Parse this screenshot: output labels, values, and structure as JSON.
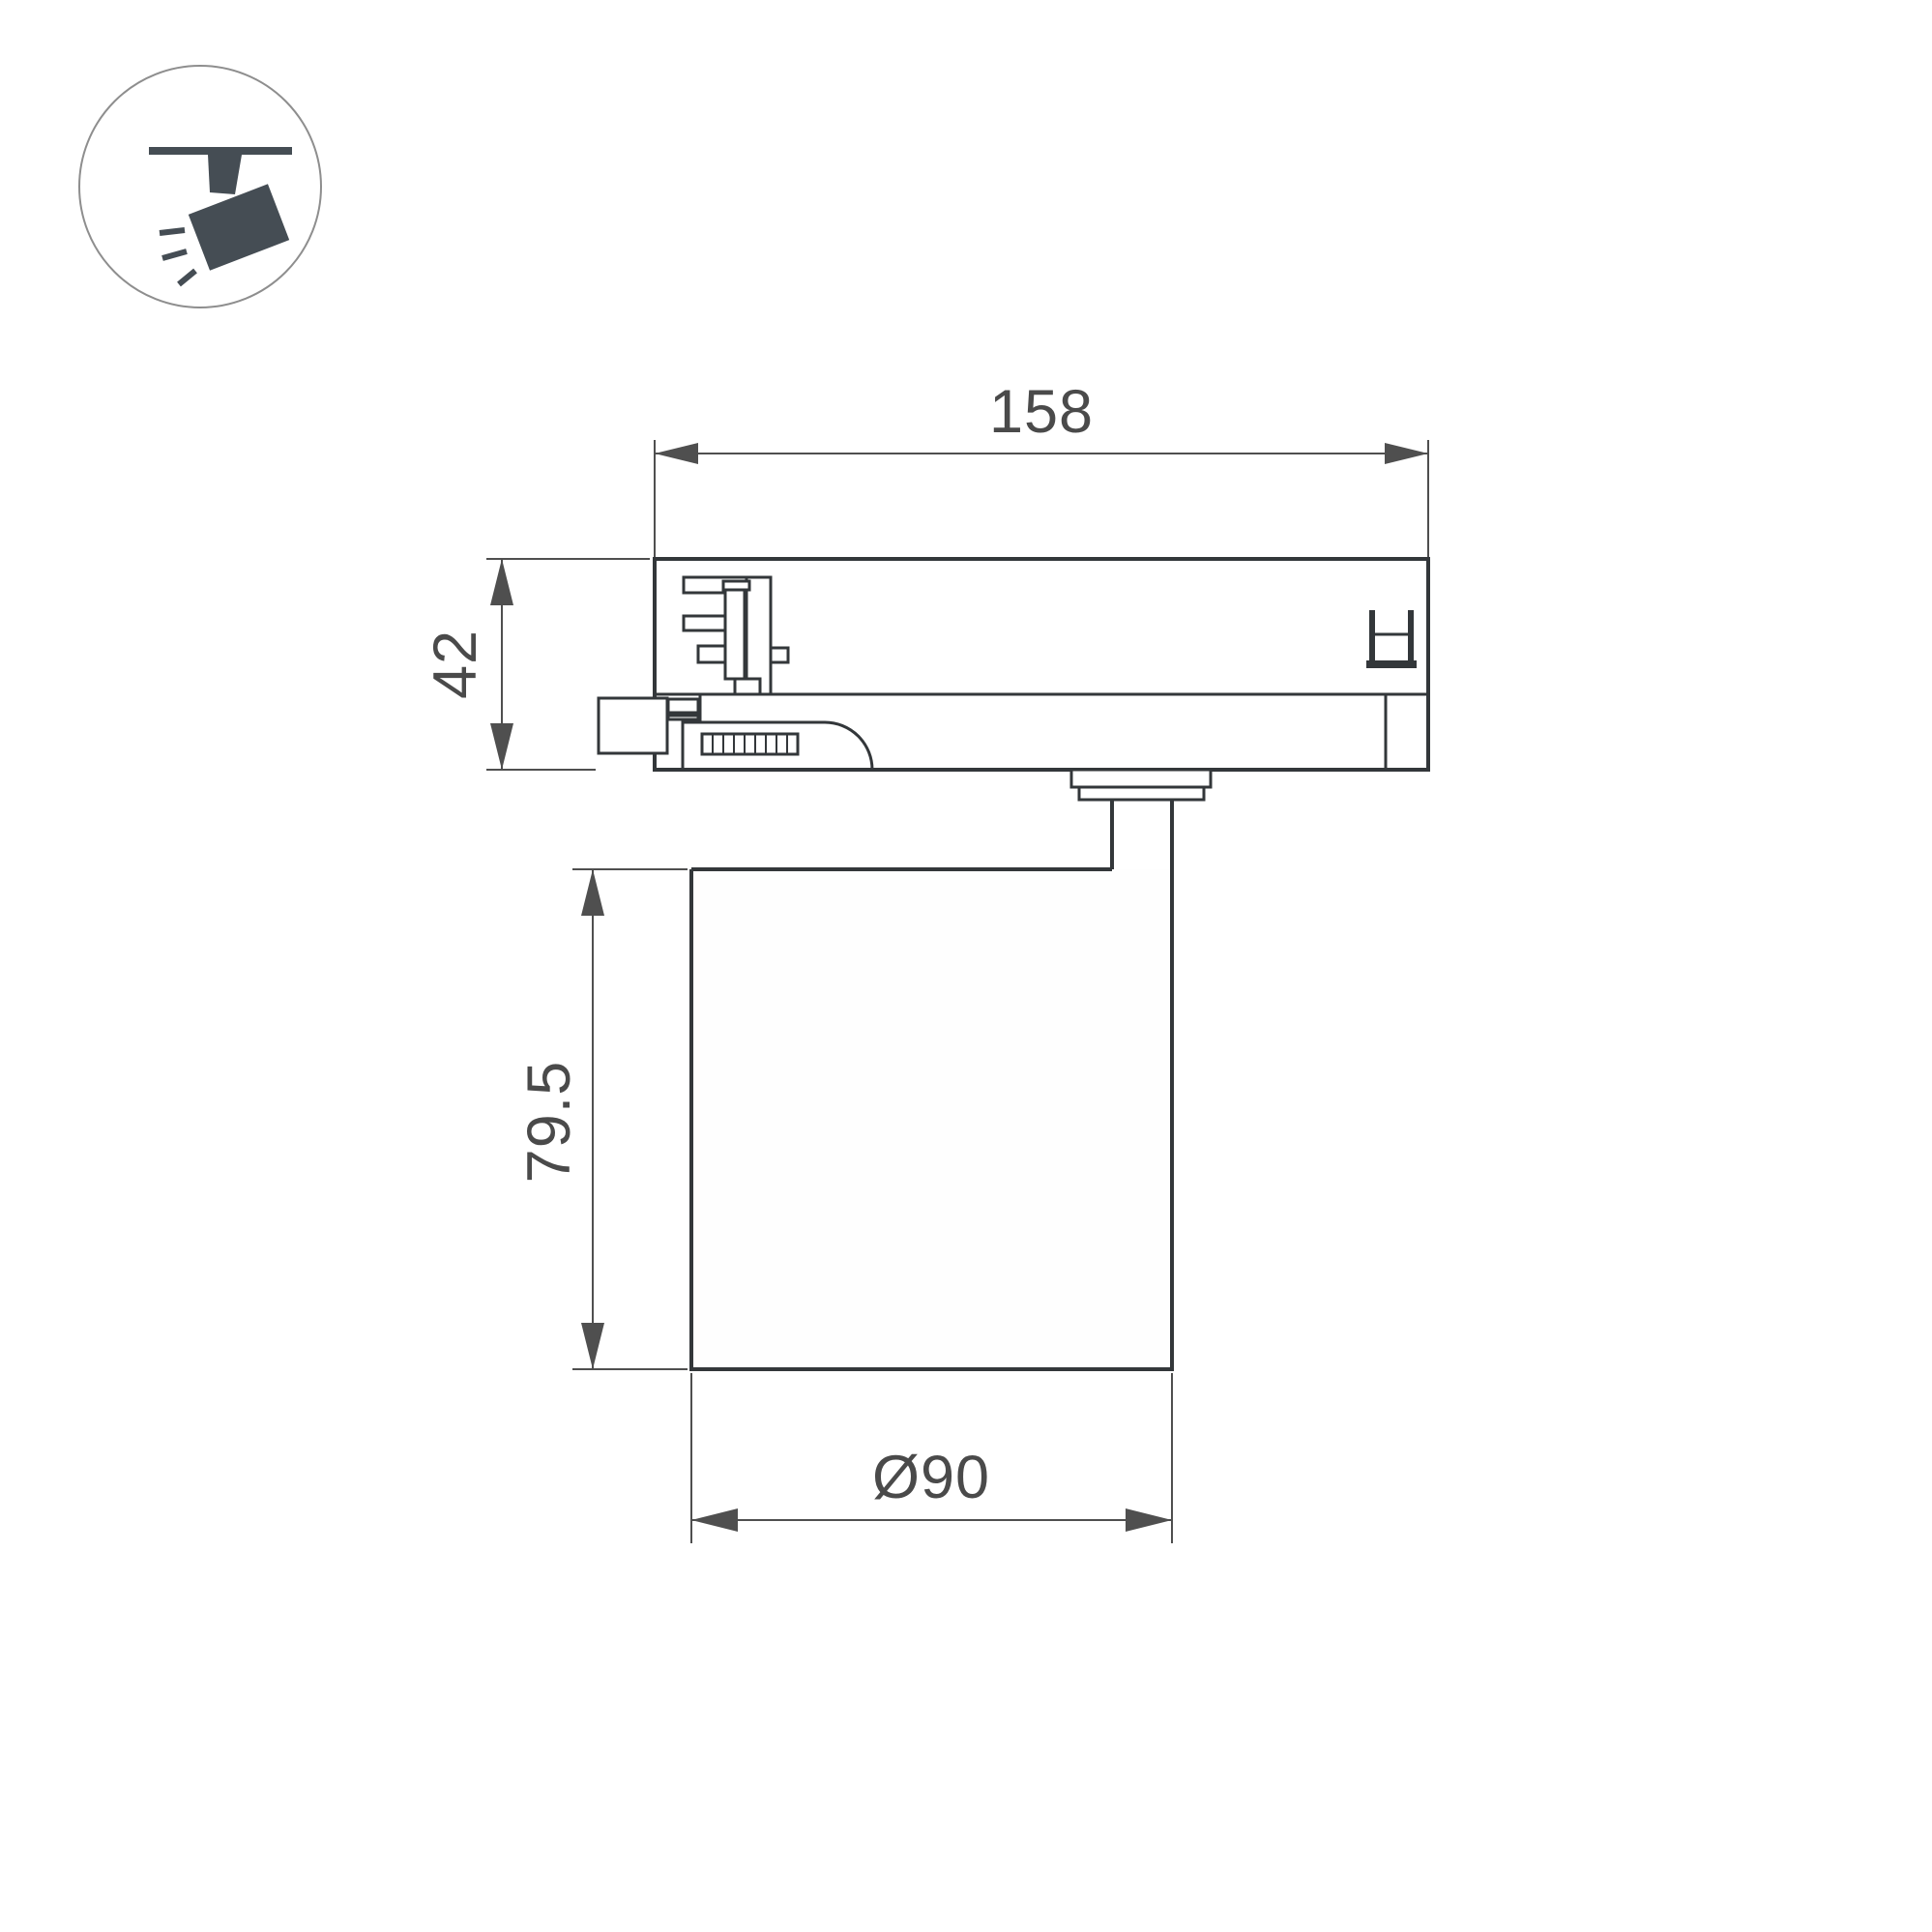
{
  "page": {
    "title": "Track spotlight dimensional drawing",
    "background": "#ffffff"
  },
  "colors": {
    "outline": "#33373a",
    "dimension_lines": "#4f4f4f",
    "dimension_text": "#4a4a4a",
    "icon": "#454d54",
    "icon_circle_border": "#8e8e8e"
  },
  "icon": {
    "name": "track-spotlight-icon",
    "description": "ceiling track with tilted spotlight head and light rays"
  },
  "dimensions": {
    "track_adapter_width": {
      "label": "158",
      "value": 158
    },
    "track_adapter_height": {
      "label": "42",
      "value": 42
    },
    "lamp_body_height": {
      "label": "79.5",
      "value": 79.5
    },
    "lamp_body_diameter": {
      "label": "Ø90",
      "value": 90
    }
  }
}
